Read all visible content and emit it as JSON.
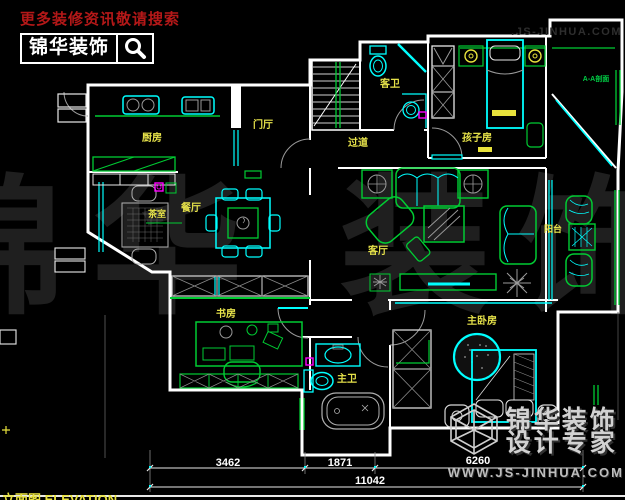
{
  "branding": {
    "top_left": {
      "tagline": "更多装修资讯敬请搜索",
      "logo_text": "锦华装饰"
    },
    "top_right_watermark": ".JS-JINHUA.COM",
    "center_watermark": "锦华 装饰",
    "bottom_right": {
      "line1": "锦华装饰",
      "line2": "设计专家",
      "website": "WWW.JS-JINHUA.COM"
    }
  },
  "rooms": {
    "kitchen": "厨房",
    "foyer": "门厅",
    "guest_bath": "客卫",
    "hallway": "过道",
    "kids_room": "孩子房",
    "tea_room": "茶室",
    "dining_room": "餐厅",
    "living_room": "客厅",
    "balcony": "阳台",
    "study": "书房",
    "master_bath": "主卫",
    "master_bedroom": "主卧房"
  },
  "annotations": {
    "section_mark": "A-A剖面",
    "title": "立面图 ELEVATION"
  },
  "dimensions": {
    "seg1": "3462",
    "seg2": "1871",
    "seg3": "6260",
    "total": "11042"
  },
  "colors": {
    "background": "#000000",
    "walls": "#ffffff",
    "fixtures_cyan": "#00ffff",
    "furniture_green": "#00ff00",
    "label_yellow": "#e6e24a",
    "tagline_red": "#b41818",
    "window_green": "#00cc33",
    "accent_magenta": "#ff00ff"
  }
}
